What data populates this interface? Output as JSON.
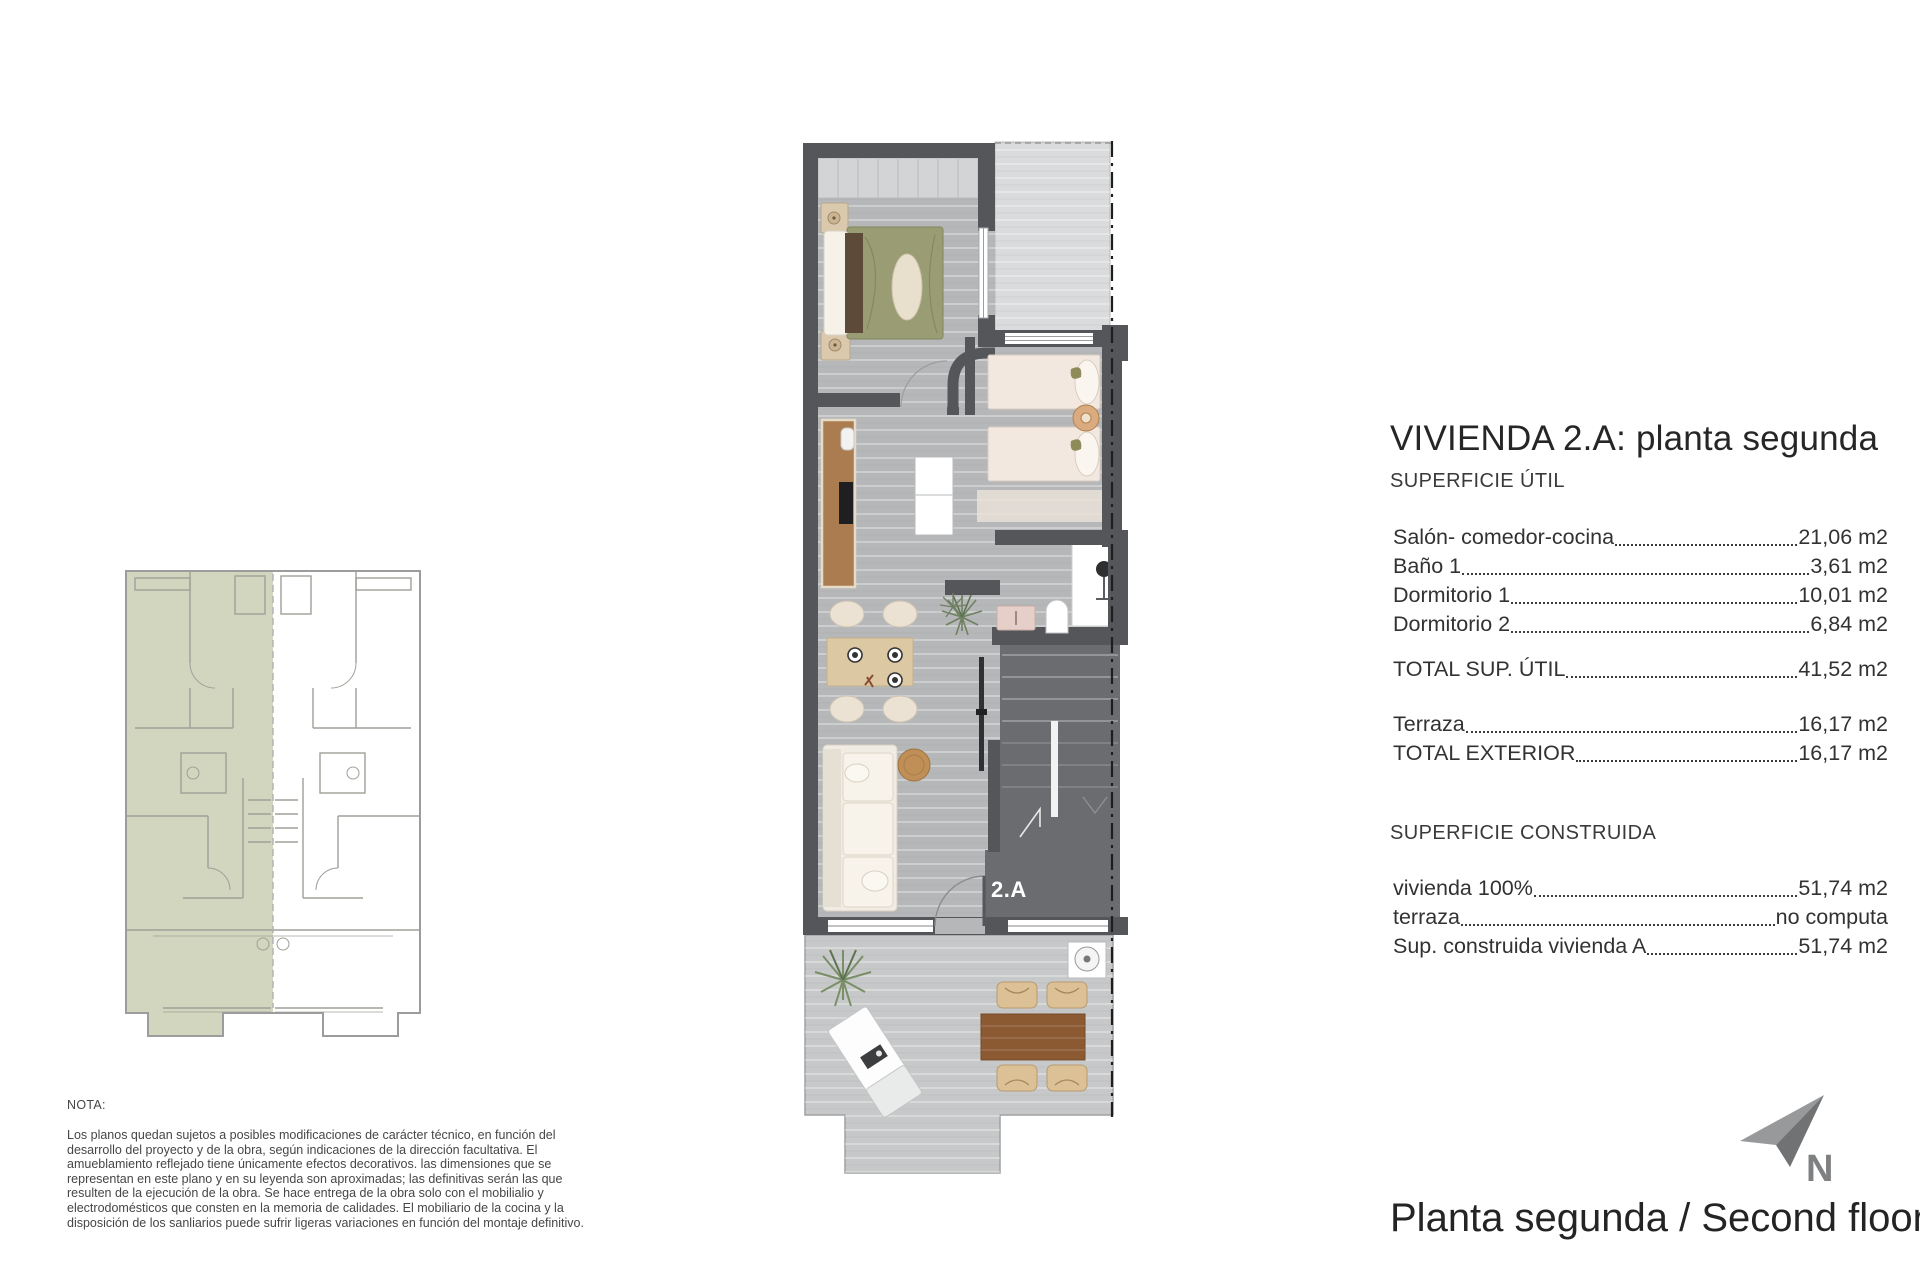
{
  "right_panel": {
    "title": "VIVIENDA 2.A: planta segunda",
    "superficie_util": {
      "heading": "SUPERFICIE ÚTIL",
      "rows": [
        {
          "label": "Salón- comedor-cocina",
          "value": "21,06 m2"
        },
        {
          "label": "Baño 1",
          "value": "3,61 m2"
        },
        {
          "label": "Dormitorio 1",
          "value": "10,01 m2"
        },
        {
          "label": "Dormitorio 2",
          "value": "6,84 m2"
        }
      ],
      "total": {
        "label": "TOTAL SUP. ÚTIL",
        "value": "41,52 m2"
      }
    },
    "exterior": {
      "rows": [
        {
          "label": "Terraza",
          "value": "16,17 m2"
        },
        {
          "label": "TOTAL EXTERIOR",
          "value": "16,17 m2"
        }
      ]
    },
    "superficie_construida": {
      "heading": "SUPERFICIE CONSTRUIDA",
      "rows": [
        {
          "label": "vivienda 100%",
          "value": "51,74 m2"
        },
        {
          "label": "terraza",
          "value": "no computa"
        },
        {
          "label": "Sup. construida vivienda A",
          "value": "51,74 m2"
        }
      ]
    }
  },
  "plan": {
    "unit_label": "2.A"
  },
  "note": {
    "heading": "NOTA:",
    "body": "Los planos quedan sujetos a posibles modificaciones de carácter técnico, en función del desarrollo del proyecto y de la obra, según indicaciones de la dirección facultativa. El amueblamiento reflejado tiene únicamente efectos decorativos. las dimensiones que se representan en este plano y en su leyenda son aproximadas; las definitivas serán las que resulten de la ejecución de la obra. Se hace entrega de la obra solo con el mobilialio y electrodomésticos que consten en la memoria de calidades. El mobiliario de la cocina y la disposición de los sanliarios puede sufrir ligeras variaciones en función del montaje definitivo."
  },
  "footer": {
    "caption": "Planta segunda / Second floor",
    "north_label": "N"
  },
  "colors": {
    "wall": "#54565a",
    "floor": "#b5b7b9",
    "terrace_upper": "#dadbdc",
    "terrace_lower": "#c7c8c9",
    "stairs": "#6a6c6f",
    "keyplan_highlight": "#cfd3ba",
    "bed_duvet_olive": "#9a9d74",
    "kitchen_wood": "#ab7c4f",
    "terrace_table_wood": "#8b5a33",
    "north_arrow_gray": "#85878a"
  }
}
